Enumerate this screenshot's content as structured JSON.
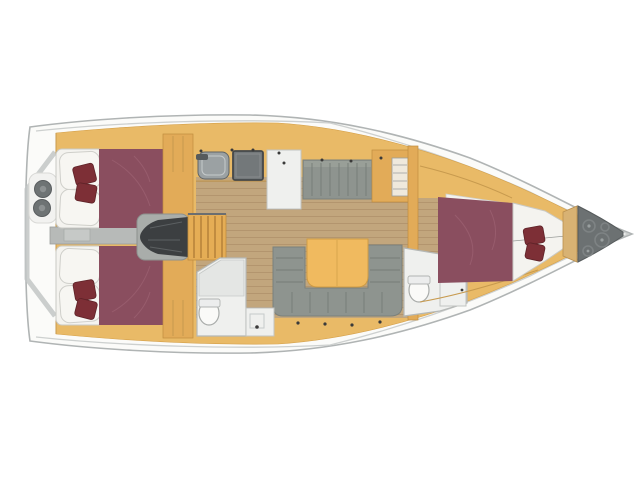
{
  "plan": {
    "kind": "sailing-yacht-interior-layout",
    "view": "top-down, bow pointing right",
    "canvas": {
      "width": 640,
      "height": 479
    }
  },
  "colors": {
    "hull_fill": "#fbfbf9",
    "hull_stroke": "#b0b4b4",
    "deck_line": "#cdd0cf",
    "interior_orange": "#e9ba67",
    "cabinet_edge": "#d5a049",
    "cabinet_orange_dark": "#e2ab58",
    "floor_wood": "#c2a67d",
    "floor_line": "#b0916a",
    "corridor_gray": "#b7bab8",
    "bed_maroon": "#8a4e5f",
    "bed_fold": "#9c6172",
    "pillow_white": "#f4f3ef",
    "pillow_stroke": "#c9c9c4",
    "cushion_red": "#7d2f36",
    "settee_gray": "#8e948f",
    "settee_line": "#767c77",
    "settee_light": "#a2a7a1",
    "table_orange": "#f0ba5f",
    "engine_dark": "#3c3f41",
    "engine_case": "#a9adaa",
    "stair_orange": "#e5ad55",
    "stair_line": "#b8843b",
    "stove_gray": "#73787a",
    "sink_gray": "#9ba1a3",
    "appliance_stroke": "#5f6466",
    "white_room": "#eff0ee",
    "room_stroke": "#b5b8b6",
    "toilet_white": "#fafaf8",
    "locker_gray": "#6c7172",
    "chain_gray": "#7e8384",
    "bow_bulkhead_tan": "#d8b273",
    "dot_dark": "#3a3a3a"
  },
  "regions": {
    "stern": "transom with two deck winches",
    "aft_cabins": "two double berths with pillows and red cushions",
    "companionway": "engine compartment under stairs",
    "galley": "sink, stove, refrigerator counter",
    "salon": "straight settee, U-settee with folding table",
    "aft_head": "shower, toilet, washbasin",
    "forward_head": "toilet and washbasin",
    "forward_cabin": "V-berth with pillows and red cushions",
    "bow": "anchor locker with chain coils"
  }
}
